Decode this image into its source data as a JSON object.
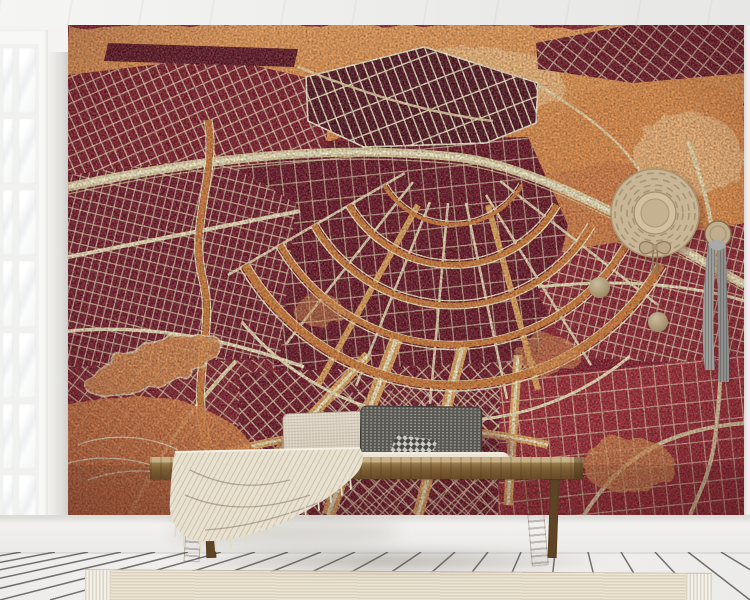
{
  "scene": {
    "type": "interior product photo",
    "description": "Bright room corner with a large watercolor city-map wall mural in reds and oranges, a white french window on the left, a rustic wooden bench with a two-tone lumbar cushion and a cream fringed throw, a straw hat and a grey scarf hanging from wooden wall knobs, and a ribbed beige runner rug on a white plank floor."
  },
  "wall_mural": {
    "name": "watercolor city map mural",
    "subject": "canal-ring street map (Amsterdam style)",
    "features": [
      "orange watercolor harbour across the top",
      "dark red city blocks with cream street grids",
      "concentric orange canal arcs",
      "radiating cream avenues",
      "pale railway band",
      "orange park patches"
    ]
  },
  "objects": [
    {
      "name": "french-window",
      "description": "white multi-pane glass door, left edge"
    },
    {
      "name": "wooden-bench",
      "description": "rustic bench with splayed legs"
    },
    {
      "name": "lumbar-pillow",
      "description": "long cushion, oatmeal left half, dark grey woven right half with checkered patch"
    },
    {
      "name": "rolled-throw",
      "description": "pale rolled blanket on the seat"
    },
    {
      "name": "throw-blanket",
      "description": "cream fringed throw draped over left end of bench"
    },
    {
      "name": "straw-hat",
      "description": "round straw hat with concentric stitching and bow, hung on wall"
    },
    {
      "name": "grey-scarf",
      "description": "grey ribbed scarf hanging from a wooden knob"
    },
    {
      "name": "wall-knobs",
      "count": 3,
      "description": "round wooden wall hooks"
    },
    {
      "name": "runner-rug",
      "description": "ribbed beige rug with fringed ends"
    },
    {
      "name": "plank-floor",
      "description": "white wooden floorboards in perspective"
    }
  ],
  "palette": {
    "ceiling": "#ececea",
    "wall": "#f4f3f1",
    "wall-shade": "#cfcecb",
    "window-frame": "#f8f8f6",
    "window-pane": "#fdfdfd",
    "baseboard": "#f0efed",
    "floor": "#f3f2f0",
    "floor-gap": "#3b3b38",
    "mural-land": "#8e1f2d",
    "mural-block-dark": "#5d1120",
    "mural-block-bright": "#a8242e",
    "mural-water": "#de8340",
    "mural-water-light": "#f3bd80",
    "mural-road": "#efe3bb",
    "mural-road-bright": "#f6edcb",
    "mural-canal": "#cf7733",
    "bench-wood": "#8a6b3f",
    "bench-wood-dark": "#67492a",
    "pillow-light": "#d0c6b3",
    "pillow-dark": "#595752",
    "blanket": "#e8e1d0",
    "rug": "#e7e0cf",
    "rug-rib": "#dbd3bf",
    "scarf": "#9c9c9a",
    "hat-straw": "#c8b696",
    "knob-wood": "#b3a085"
  }
}
